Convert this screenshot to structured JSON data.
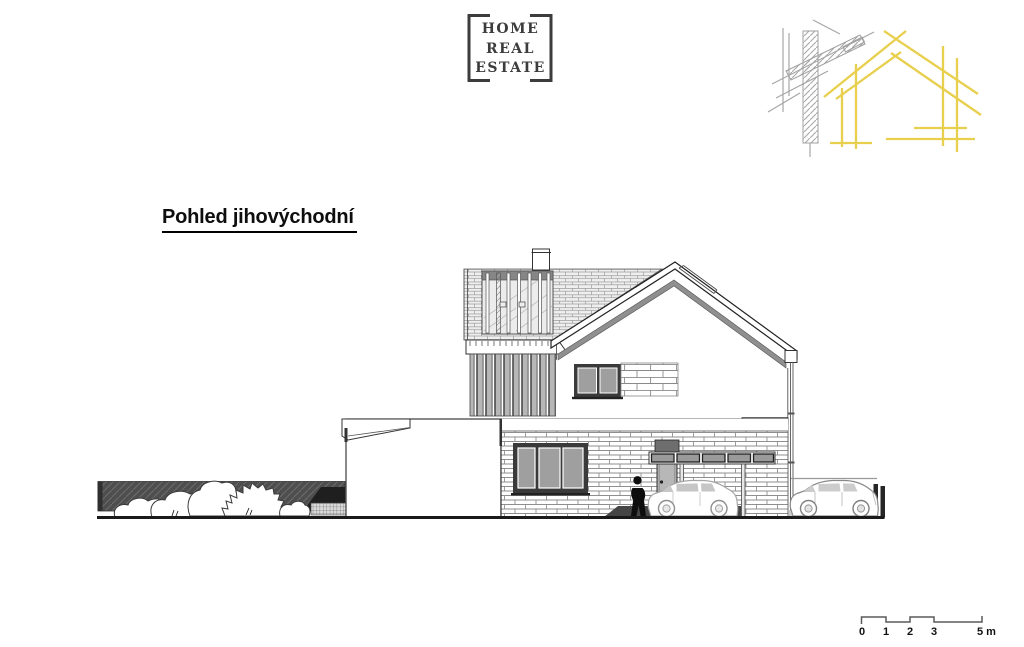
{
  "page": {
    "background": "#ffffff"
  },
  "logo": {
    "line1": "HOME",
    "line2": "REAL",
    "line3": "ESTATE",
    "frame_color": "#3c3c3c"
  },
  "brand_graphic": {
    "name": "construction-sketch",
    "accent_yellow": "#E8CF4D",
    "sketch_gray": "#A6A6A6"
  },
  "title": {
    "text": "Pohled jihovýchodní"
  },
  "drawing": {
    "name": "house-southeast-elevation",
    "ink": "#3a3a3a",
    "parts": [
      "garden-fence",
      "shrubs",
      "single-storey-annex",
      "louvred-balcony",
      "chimney",
      "gable-roof",
      "gutter-downspout",
      "upper-window",
      "masonry-band",
      "ground-floor-window",
      "entrance-door",
      "door-canopy",
      "person",
      "car-under-canopy",
      "parked-car",
      "boundary-posts",
      "ground-shadow",
      "ground-line"
    ]
  },
  "scale_bar": {
    "labels": [
      "0",
      "1",
      "2",
      "3",
      "5 m"
    ]
  }
}
